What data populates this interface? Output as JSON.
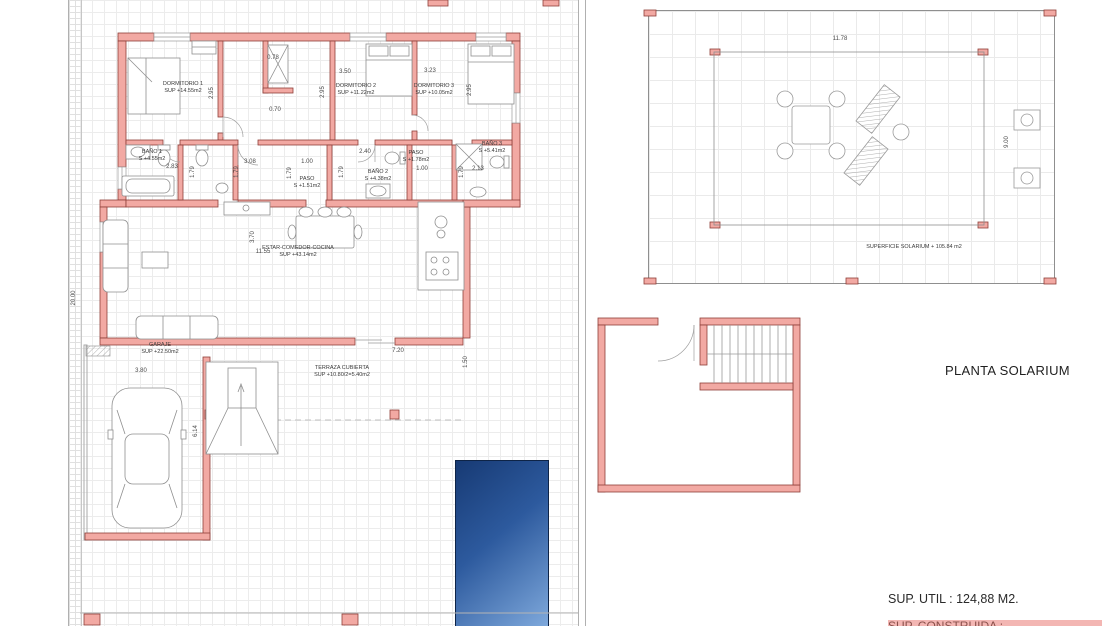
{
  "plan_left": {
    "rooms": [
      {
        "name": "DORMITORIO 1",
        "area": "SUP +14.55m2"
      },
      {
        "name": "DORMITORIO 2",
        "area": "SUP +11.22m2"
      },
      {
        "name": "DORMITORIO 3",
        "area": "SUP +10.05m2"
      },
      {
        "name": "BAÑO 1",
        "area": "S +4.55m2"
      },
      {
        "name": "BAÑO 2",
        "area": "S +4.38m2"
      },
      {
        "name": "BAÑO 3",
        "area": "S +5.41m2"
      },
      {
        "name": "PASO",
        "area": "S +1.51m2"
      },
      {
        "name": "PASO",
        "area": "S +1.78m2"
      },
      {
        "name": "ESTAR-COMEDOR-COCINA",
        "area": "SUP +43.14m2"
      },
      {
        "name": "GARAJE",
        "area": "SUP +22.50m2"
      },
      {
        "name": "TERRAZA CUBIERTA",
        "area": "SUP +10.80/2=5.40m2"
      }
    ],
    "dims": [
      {
        "t": "2.95",
        "x": 212,
        "y": 93,
        "o": "v"
      },
      {
        "t": "0.78",
        "x": 273,
        "y": 58,
        "o": "h"
      },
      {
        "t": "3.50",
        "x": 345,
        "y": 72,
        "o": "h"
      },
      {
        "t": "2.95",
        "x": 323,
        "y": 92,
        "o": "v"
      },
      {
        "t": "0.70",
        "x": 275,
        "y": 110,
        "o": "h"
      },
      {
        "t": "3.23",
        "x": 430,
        "y": 71,
        "o": "h"
      },
      {
        "t": "2.95",
        "x": 470,
        "y": 90,
        "o": "v"
      },
      {
        "t": "2.83",
        "x": 172,
        "y": 167,
        "o": "h"
      },
      {
        "t": "1.79",
        "x": 193,
        "y": 172,
        "o": "v"
      },
      {
        "t": "3.08",
        "x": 250,
        "y": 162,
        "o": "h"
      },
      {
        "t": "1.00",
        "x": 307,
        "y": 162,
        "o": "h"
      },
      {
        "t": "1.79",
        "x": 237,
        "y": 172,
        "o": "v"
      },
      {
        "t": "1.79",
        "x": 290,
        "y": 173,
        "o": "v"
      },
      {
        "t": "2.40",
        "x": 365,
        "y": 152,
        "o": "h"
      },
      {
        "t": "1.79",
        "x": 342,
        "y": 172,
        "o": "v"
      },
      {
        "t": "1.00",
        "x": 422,
        "y": 169,
        "o": "h"
      },
      {
        "t": "1.79",
        "x": 462,
        "y": 172,
        "o": "v"
      },
      {
        "t": "2.13",
        "x": 478,
        "y": 169,
        "o": "h"
      },
      {
        "t": "3.70",
        "x": 253,
        "y": 237,
        "o": "v"
      },
      {
        "t": "11.55",
        "x": 263,
        "y": 252,
        "o": "h"
      },
      {
        "t": "7.20",
        "x": 398,
        "y": 351,
        "o": "h"
      },
      {
        "t": "1.50",
        "x": 466,
        "y": 362,
        "o": "v"
      },
      {
        "t": "3.80",
        "x": 141,
        "y": 371,
        "o": "h"
      },
      {
        "t": "6.14",
        "x": 196,
        "y": 431,
        "o": "v"
      },
      {
        "t": "20.00",
        "x": 74,
        "y": 298,
        "o": "v"
      }
    ]
  },
  "plan_right": {
    "title": "PLANTA SOLARIUM",
    "surface_label": "SUPERFICIE SOLARIUM + 105.84 m2",
    "dims": [
      {
        "t": "11.78",
        "x": 840,
        "y": 39,
        "o": "h"
      },
      {
        "t": "9.00",
        "x": 1007,
        "y": 142,
        "o": "v"
      }
    ]
  },
  "footer": {
    "sup_util": "SUP. UTIL : 124,88 M2.",
    "sup_construida_partial": "SUP. CONSTRUIDA :"
  },
  "colors": {
    "wall_fill": "#F2A9A3",
    "wall_stroke": "#8E3F39",
    "pool_dark": "#173a74",
    "pool_light": "#7fa9dc",
    "grid_line": "#ececec",
    "highlight": "#f3b6b3"
  }
}
